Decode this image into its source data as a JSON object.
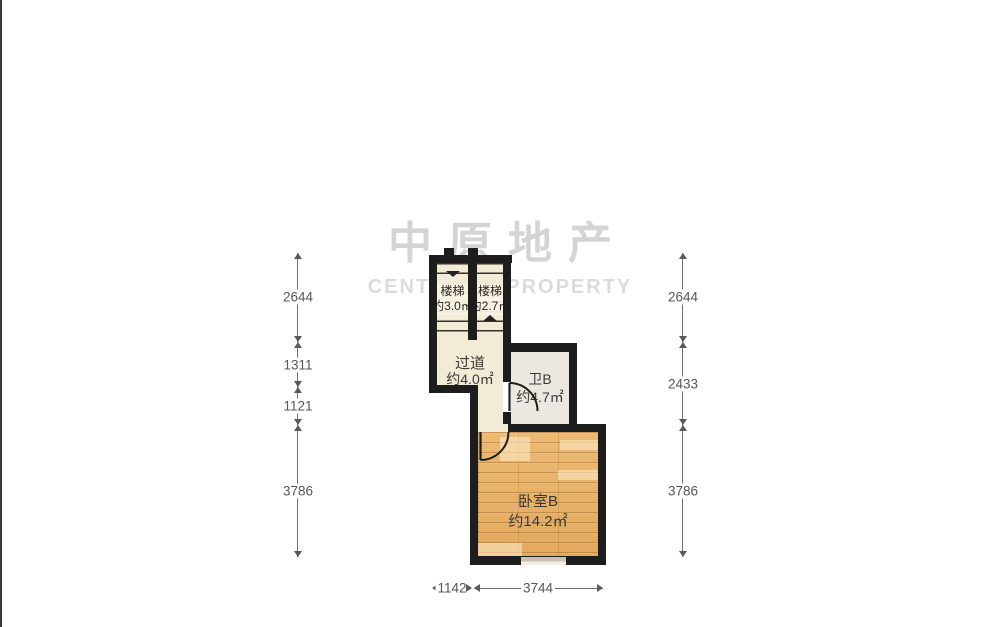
{
  "watermark": {
    "title_cn": "中原地产",
    "title_en": "CENTALINE PROPERTY"
  },
  "rooms": {
    "stair_left": {
      "name": "楼梯",
      "area": "约3.0㎡"
    },
    "stair_right": {
      "name": "楼梯",
      "area": "约2.7㎡"
    },
    "hallway": {
      "name": "过道",
      "area": "约4.0㎡"
    },
    "bathroom_b": {
      "name": "卫B",
      "area": "约4.7㎡"
    },
    "bedroom_b": {
      "name": "卧室B",
      "area": "约14.2㎡"
    }
  },
  "dimensions": {
    "left": [
      "2644",
      "1311",
      "1121",
      "3786"
    ],
    "right": [
      "2644",
      "2433",
      "3786"
    ],
    "bottom": [
      "1142",
      "3744"
    ]
  },
  "colors": {
    "wall": "#1d1d1d",
    "floor_cream": "#f2ebd5",
    "floor_bath": "#ede8df",
    "floor_wood": "#e8b26a",
    "watermark_gray": "#c8c8c8",
    "dimension_text": "#565656"
  }
}
